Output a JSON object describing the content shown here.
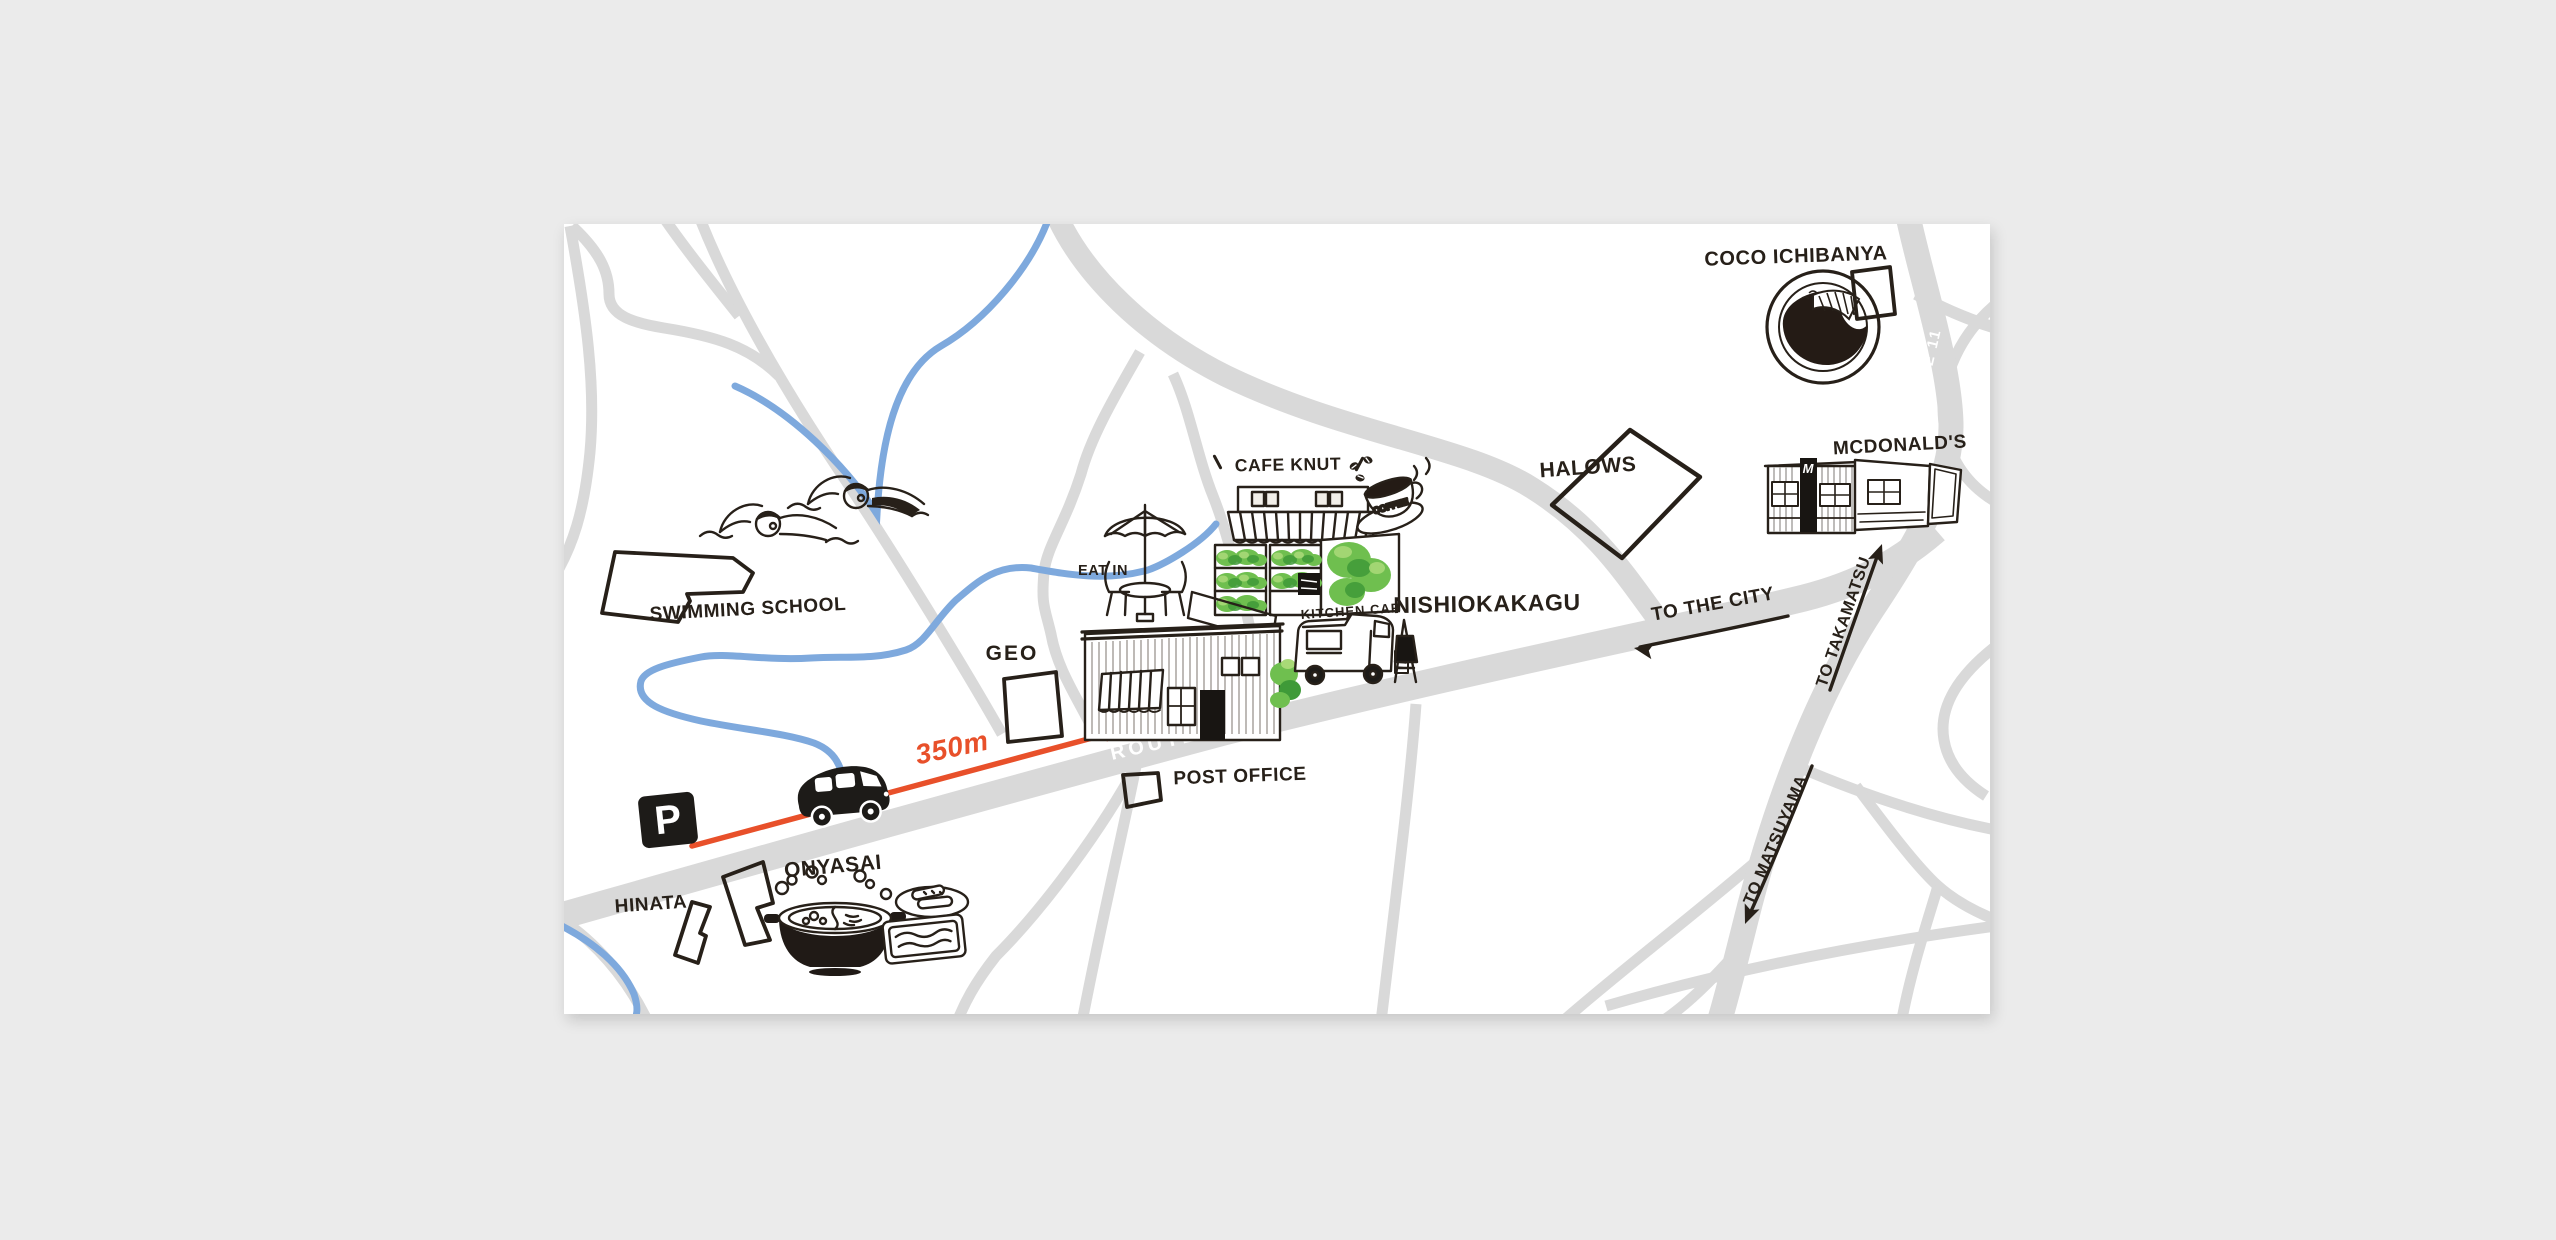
{
  "map": {
    "background_color": "#ebebeb",
    "card_color": "#ffffff",
    "colors": {
      "road": "#d9d9d9",
      "river": "#7ea9dd",
      "ink": "#272019",
      "accent_red": "#e8502a",
      "green_dark": "#3f9a38",
      "green": "#6fbf4f",
      "green_light": "#a8d977"
    },
    "roads": {
      "route237": "ROUTE 237",
      "route11": "ROUTE 11"
    },
    "directions": {
      "city": "TO THE CITY",
      "takamatsu": "TO TAKAMATSU",
      "matsuyama": "TO MATSUYAMA"
    },
    "markers": {
      "parking": "P",
      "distance": "350m",
      "coffee": "COFFEE",
      "mcdonalds_sign": "M"
    },
    "places": {
      "swimming_school": "SWIMMING SCHOOL",
      "geo": "GEO",
      "post_office": "POST OFFICE",
      "hinata": "HINATA",
      "onyasai": "ONYASAI",
      "cafe_knut": "CAFE KNUT",
      "eat_in": "EAT IN",
      "kitchen_car": "KITCHEN CAR",
      "nishiokakagu": "NISHIOKAKAGU",
      "halows": "HALOWS",
      "coco_ichibanya": "COCO ICHIBANYA",
      "mcdonalds": "MCDONALD'S"
    }
  }
}
